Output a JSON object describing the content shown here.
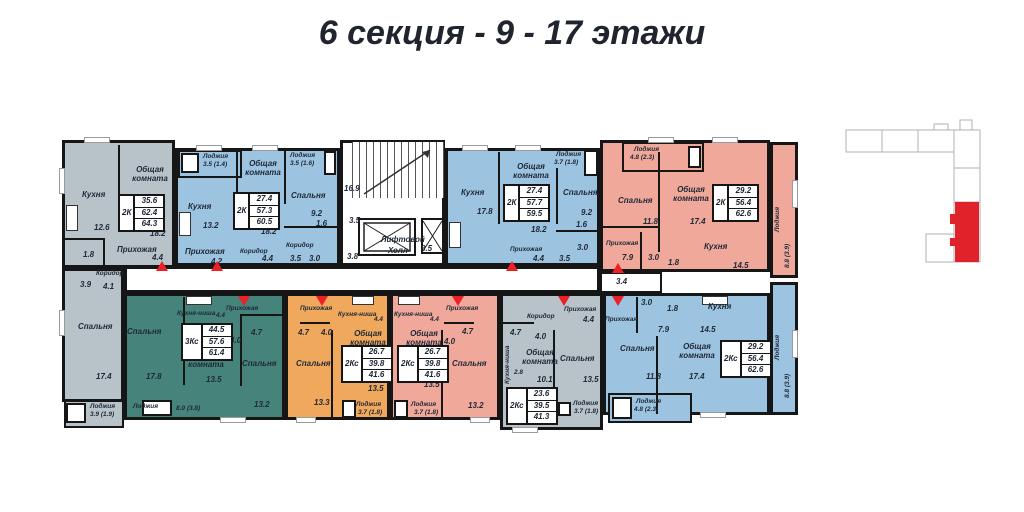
{
  "title": "6 секция - 9 - 17 этажи",
  "labels": {
    "kitchen": "Кухня",
    "kitchen_niche": "Кухня-ниша",
    "living_room": "Общая комната",
    "bedroom": "Спальня",
    "hall": "Прихожая",
    "corridor": "Коридор",
    "loggia": "Лоджия",
    "lift_hall_line1": "Лифтовой",
    "lift_hall_line2": "Холл"
  },
  "core": {
    "stairs_area": "16.9",
    "vestibule1": "3.5",
    "vestibule2": "3.8",
    "lift_hall_area": "8.5"
  },
  "shared_corridor_area": "3.4",
  "apartments": {
    "a1": {
      "type": "2К",
      "living": "35.6",
      "total": "62.4",
      "full": "64.3",
      "kitchen": "12.6",
      "living_room": "18.2",
      "hall": "4.4",
      "wc": "1.8",
      "bath": "3.9",
      "corridor": "4.1",
      "bedroom": "17.4",
      "loggia": "3.9 (1.9)"
    },
    "a2": {
      "type": "2К",
      "living": "27.4",
      "total": "57.3",
      "full": "60.5",
      "loggia1": "3.5 (1.4)",
      "kitchen": "13.2",
      "living_room": "18.2",
      "hall": "4.2",
      "corridor1": "4.4",
      "corridor2": "3.5",
      "wc": "1.6",
      "bath": "3.0",
      "bedroom": "9.2",
      "loggia2": "3.5 (1.6)"
    },
    "a3": {
      "type": "2К",
      "living": "27.4",
      "total": "57.7",
      "full": "59.5",
      "kitchen": "17.8",
      "living_room": "18.2",
      "hall": "4.4",
      "corridor": "3.5",
      "wc": "1.6",
      "bath": "3.0",
      "bedroom": "9.2",
      "loggia": "3.7 (1.8)"
    },
    "a4": {
      "type": "2К",
      "living": "29.2",
      "total": "56.4",
      "full": "62.6",
      "loggia_top": "4.8 (2.3)",
      "bedroom": "11.8",
      "living_room": "17.4",
      "kitchen": "14.5",
      "hall": "7.9",
      "bath": "3.0",
      "wc": "1.8",
      "loggia_side": "8.8 (3.9)"
    },
    "a5": {
      "type": "3Кс",
      "living": "44.5",
      "total": "57.6",
      "full": "61.4",
      "bedroom1": "17.8",
      "kitchen_niche": "4.4",
      "hall": "4.0",
      "bath": "4.7",
      "bedroom2": "13.2",
      "living_room": "13.5",
      "loggia": "8.0 (3.8)"
    },
    "a6": {
      "type": "2Кс",
      "living": "26.7",
      "total": "39.8",
      "full": "41.6",
      "kitchen_niche": "4.4",
      "hall": "4.0",
      "bath": "4.7",
      "bedroom": "13.3",
      "living_room": "13.5",
      "loggia": "3.7 (1.8)"
    },
    "a7": {
      "type": "2Кс",
      "living": "26.7",
      "total": "39.8",
      "full": "41.6",
      "kitchen_niche": "4.4",
      "hall": "4.0",
      "bath": "4.7",
      "bedroom": "13.2",
      "living_room": "13.5",
      "loggia": "3.7 (1.8)"
    },
    "a8": {
      "type": "2Кс",
      "living": "23.6",
      "total": "39.5",
      "full": "41.3",
      "hall": "4.4",
      "corridor": "4.0",
      "bath": "4.7",
      "kitchen_niche": "2.8",
      "living_room": "10.1",
      "bedroom": "13.5",
      "loggia": "3.7 (1.8)"
    },
    "a9": {
      "type": "2Кс",
      "living": "29.2",
      "total": "56.4",
      "full": "62.6",
      "hall": "7.9",
      "bath": "3.0",
      "wc": "1.8",
      "kitchen": "14.5",
      "bedroom": "11.8",
      "living_room": "17.4",
      "loggia_bottom": "4.8 (2.3)",
      "loggia_side": "8.8 (3.9)"
    }
  },
  "colors": {
    "gray_apartment": "#b7c3c9",
    "blue_apartment": "#9cc3e0",
    "teal_apartment": "#45837b",
    "orange_apartment": "#f0a95c",
    "pink_apartment": "#f0a89a",
    "walls": "#161616",
    "entry_marker": "#ec2027",
    "keyplan_highlight": "#e0232b",
    "title_text": "#20242e"
  }
}
